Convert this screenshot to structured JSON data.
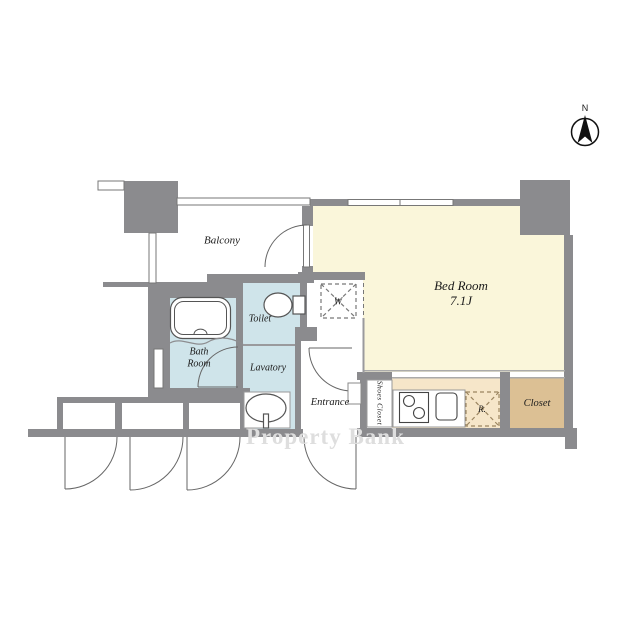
{
  "title": "Apartment floor plan",
  "compass": {
    "north_label": "N"
  },
  "rooms": {
    "balcony": "Balcony",
    "bedroom_name": "Bed Room",
    "bedroom_size": "7.1J",
    "toilet": "Toilet",
    "bath_line1": "Bath",
    "bath_line2": "Room",
    "lavatory": "Lavatory",
    "entrance": "Entrance",
    "shoes_closet": "Shoes Closet",
    "closet": "Closet"
  },
  "fixtures": {
    "washing_machine": "W",
    "refrigerator": "R."
  },
  "watermark": {
    "text": "Property Bank",
    "color": "#dedede"
  },
  "colors": {
    "wall": "#8b8b8e",
    "bedroom": "#faf6da",
    "wet_area": "#cfe4ea",
    "kitchen": "#f6e6c9",
    "closet": "#dcc094",
    "line": "#666666"
  }
}
